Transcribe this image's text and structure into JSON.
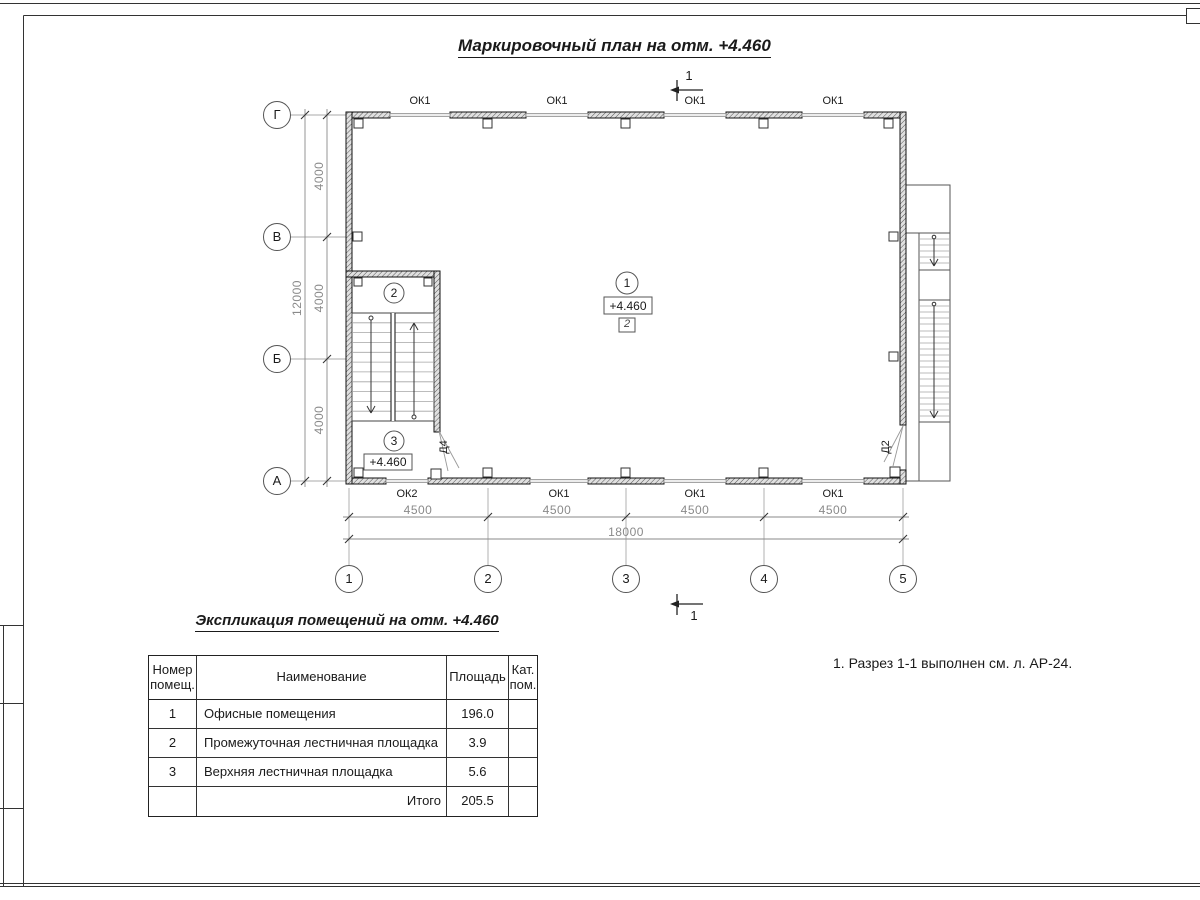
{
  "sheet": {
    "title": "Маркировочный план на отм. +4.460",
    "note": "1. Разрез 1-1 выполнен см. л. АР-24."
  },
  "plan": {
    "section_label_top": "1",
    "section_label_bottom": "1",
    "top_windows": [
      "ОК1",
      "ОК1",
      "ОК1",
      "ОК1"
    ],
    "bottom_windows": [
      "ОК2",
      "ОК1",
      "ОК1",
      "ОК1"
    ],
    "h_axes": [
      "Г",
      "В",
      "Б",
      "А"
    ],
    "v_axes": [
      "1",
      "2",
      "3",
      "4",
      "5"
    ],
    "dims": {
      "left_segments": [
        "4000",
        "4000",
        "4000"
      ],
      "left_total": "12000",
      "bottom_segments": [
        "4500",
        "4500",
        "4500",
        "4500"
      ],
      "bottom_total": "18000"
    },
    "marks": {
      "room1": "1",
      "room1_elev": "+4.460",
      "room1_floor_type": "2",
      "room2": "2",
      "room3": "3",
      "room3_elev": "+4.460",
      "door_d4": "Д4",
      "door_d2": "Д2"
    }
  },
  "schedule": {
    "title": "Экспликация помещений на отм. +4.460",
    "headers": {
      "num": "Номер помещ.",
      "name": "Наименование",
      "area": "Площадь",
      "cat": "Кат. пом."
    },
    "rows": [
      {
        "num": "1",
        "name": "Офисные помещения",
        "area": "196.0",
        "cat": ""
      },
      {
        "num": "2",
        "name": "Промежуточная лестничная площадка",
        "area": "3.9",
        "cat": ""
      },
      {
        "num": "3",
        "name": "Верхняя лестничная площадка",
        "area": "5.6",
        "cat": ""
      }
    ],
    "total_label": "Итого",
    "total_value": "205.5"
  }
}
